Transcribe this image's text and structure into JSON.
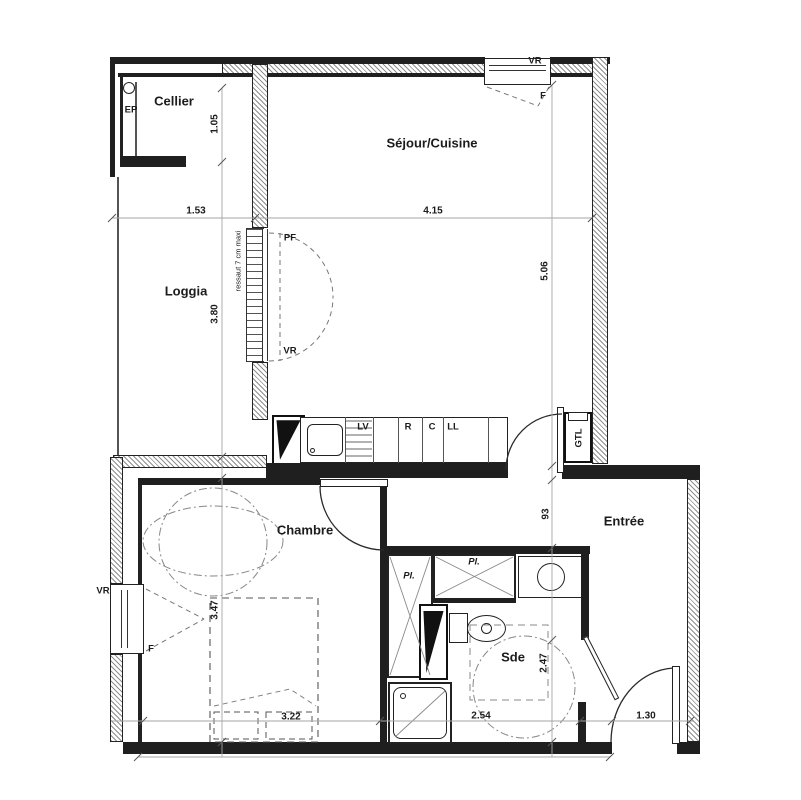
{
  "drawing": "apartment-floor-plan",
  "colors": {
    "wall": "#1f1f1f",
    "insulation_hatch": "#8f8f8f",
    "dimension_line": "#a6a6a6",
    "dashed_line": "#7a7a7a",
    "background": "#ffffff",
    "text": "#1c1c1c"
  },
  "rooms": [
    {
      "label": "Cellier",
      "x": 174,
      "y": 101,
      "rot": false
    },
    {
      "label": "Séjour/Cuisine",
      "x": 432,
      "y": 143,
      "rot": false
    },
    {
      "label": "Loggia",
      "x": 186,
      "y": 291,
      "rot": false
    },
    {
      "label": "Chambre",
      "x": 305,
      "y": 530,
      "rot": false
    },
    {
      "label": "Entrée",
      "x": 624,
      "y": 521,
      "rot": false
    },
    {
      "label": "Sde",
      "x": 513,
      "y": 657,
      "rot": false
    }
  ],
  "dimensions": [
    {
      "label": "1.53",
      "x": 196,
      "y": 211,
      "rot": false
    },
    {
      "label": "4.15",
      "x": 433,
      "y": 211,
      "rot": false
    },
    {
      "label": "1.05",
      "x": 215,
      "y": 124,
      "rot": true
    },
    {
      "label": "3.80",
      "x": 215,
      "y": 314,
      "rot": true
    },
    {
      "label": "5.06",
      "x": 545,
      "y": 271,
      "rot": true
    },
    {
      "label": "93",
      "x": 546,
      "y": 514,
      "rot": true
    },
    {
      "label": "3.47",
      "x": 215,
      "y": 610,
      "rot": true
    },
    {
      "label": "2.47",
      "x": 544,
      "y": 663,
      "rot": true
    },
    {
      "label": "3.22",
      "x": 291,
      "y": 717,
      "rot": false
    },
    {
      "label": "2.54",
      "x": 481,
      "y": 716,
      "rot": false
    },
    {
      "label": "1.30",
      "x": 646,
      "y": 716,
      "rot": false
    }
  ],
  "annotations": [
    {
      "label": "EP",
      "x": 131,
      "y": 110,
      "rot": false,
      "italic": false,
      "small": false
    },
    {
      "label": "VR",
      "x": 535,
      "y": 61,
      "rot": false,
      "italic": false,
      "small": false
    },
    {
      "label": "F",
      "x": 543,
      "y": 96,
      "rot": false,
      "italic": false,
      "small": false
    },
    {
      "label": "PF",
      "x": 290,
      "y": 238,
      "rot": false,
      "italic": false,
      "small": false
    },
    {
      "label": "VR",
      "x": 290,
      "y": 351,
      "rot": false,
      "italic": false,
      "small": false
    },
    {
      "label": "VR",
      "x": 103,
      "y": 591,
      "rot": false,
      "italic": false,
      "small": false
    },
    {
      "label": "F",
      "x": 151,
      "y": 649,
      "rot": false,
      "italic": false,
      "small": false
    },
    {
      "label": "LV",
      "x": 363,
      "y": 427,
      "rot": false,
      "italic": false,
      "small": false
    },
    {
      "label": "R",
      "x": 408,
      "y": 427,
      "rot": false,
      "italic": false,
      "small": false
    },
    {
      "label": "C",
      "x": 432,
      "y": 427,
      "rot": false,
      "italic": false,
      "small": false
    },
    {
      "label": "LL",
      "x": 453,
      "y": 427,
      "rot": false,
      "italic": false,
      "small": false
    },
    {
      "label": "GTL",
      "x": 579,
      "y": 438,
      "rot": true,
      "italic": false,
      "small": false
    },
    {
      "label": "Pl.",
      "x": 409,
      "y": 576,
      "rot": false,
      "italic": true,
      "small": false
    },
    {
      "label": "Pl.",
      "x": 474,
      "y": 562,
      "rot": false,
      "italic": true,
      "small": false
    },
    {
      "label": "ressaut 7 cm maxi",
      "x": 238,
      "y": 261,
      "rot": true,
      "italic": false,
      "small": true
    }
  ]
}
